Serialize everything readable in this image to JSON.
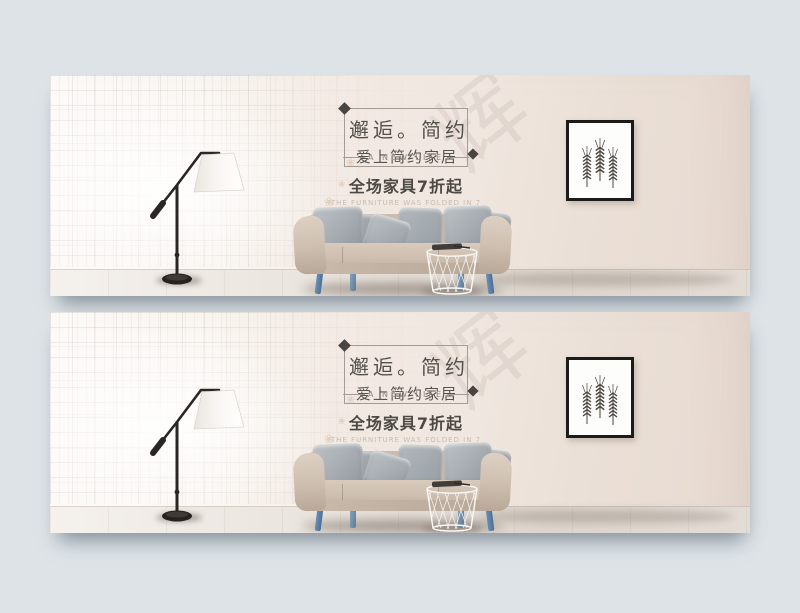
{
  "page": {
    "background_color": "#dde3e7",
    "banner_count": 2
  },
  "banner": {
    "headline_box": {
      "title": "邂逅。简约",
      "subtitle": "爱上简约家居",
      "tagline": "A NEW LIFE"
    },
    "promo": {
      "line1": "全场家具7折起",
      "line2": "THE FURNITURE WAS FOLDED IN 7"
    },
    "watermark_glyph": "辉",
    "flower_glyph": "❀",
    "colors": {
      "wall_light": "#fdfbf9",
      "wall_dark": "#e7dad1",
      "sofa_fabric": "#ccbeb0",
      "pillow_gray": "#a9b0b5",
      "sofa_leg_blue": "#5b81a7",
      "frame_black": "#1d1b19",
      "title_text": "#53504c"
    },
    "objects": [
      "floor-lamp",
      "sofa",
      "wire-basket-table",
      "wheat-picture-frame"
    ]
  }
}
